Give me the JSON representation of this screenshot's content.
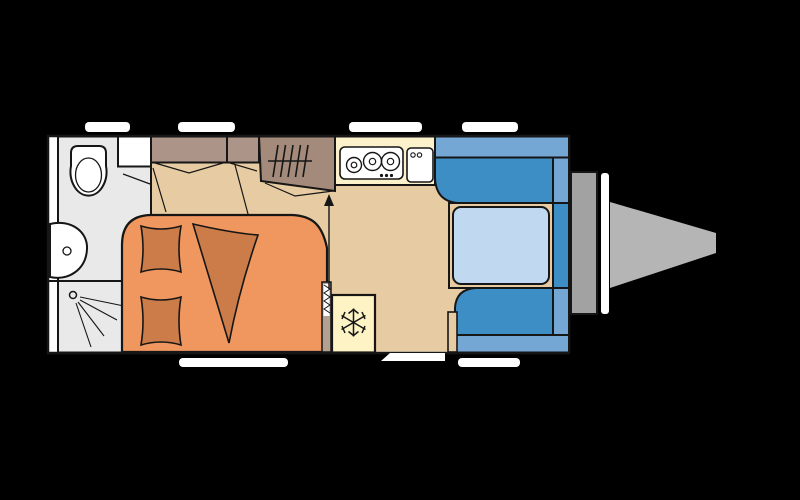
{
  "scene": {
    "title": "caravan-floor-plan"
  },
  "colors": {
    "background": "#000000",
    "outline": "#161616",
    "body_white": "#ffffff",
    "floor_tan": "#e7cba2",
    "bathroom_grey": "#e9e9e9",
    "fixture_white": "#ffffff",
    "cabinet_brown": "#ad9488",
    "heater_brown": "#a38a7a",
    "bed_orange": "#f0975f",
    "bedding_dark_orange": "#cb7c49",
    "kitchen_cream": "#fbf2cb",
    "fridge_cream": "#fdf3c5",
    "seat_blue": "#3e8ec6",
    "backrest_blue": "#74a7d4",
    "table_blue": "#c0d8f0",
    "partition_taupe": "#b2a090",
    "hitch_grey_dark": "#a2a2a2",
    "hitch_grey_light": "#b5b5b5",
    "window_white": "#ffffff"
  },
  "features": {
    "bathroom": "bathroom",
    "toilet": "toilet",
    "washbasin": "washbasin",
    "shower": "shower",
    "wardrobe": "overhead-cabinets",
    "heater": "heater",
    "double_bed": "double-bed",
    "pillows": "pillows",
    "blanket": "blanket",
    "kitchen": "kitchen-block",
    "stove": "three-burner-stove",
    "kitchen_sink": "kitchen-sink",
    "fridge": "fridge",
    "dinette": "dinette-seating",
    "table": "table",
    "entrance": "entrance-door",
    "drawbar": "drawbar-hitch",
    "windows": "windows"
  }
}
